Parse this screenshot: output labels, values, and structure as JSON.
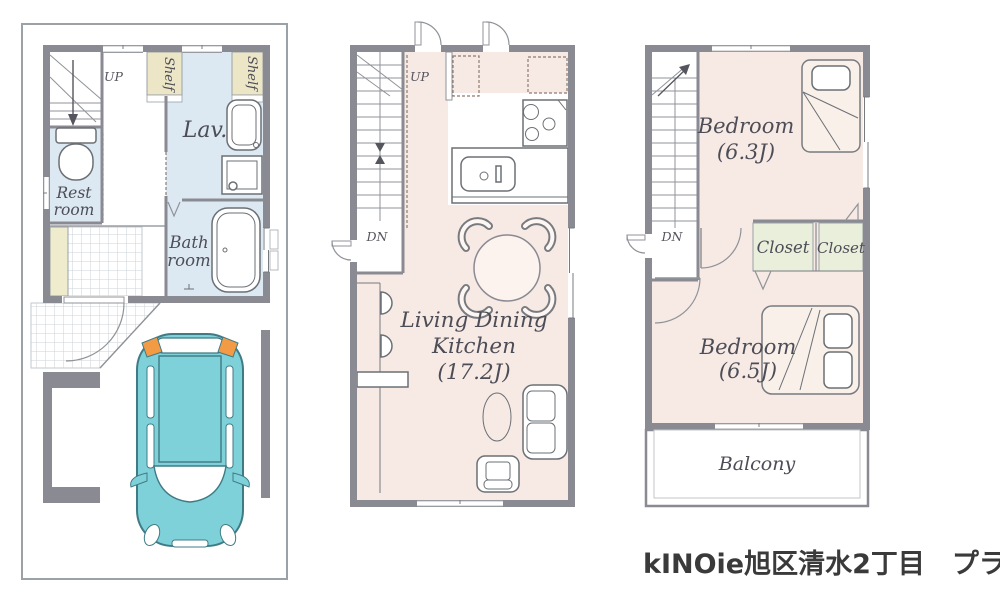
{
  "title": {
    "text": "kINOie旭区清水2丁目　プラン"
  },
  "floor1": {
    "up": "UP",
    "shelf_a": "Shelf",
    "shelf_b": "Shelf",
    "lavatory": "Lav.",
    "restroom_line1": "Rest",
    "restroom_line2": "room",
    "bathroom_line1": "Bath",
    "bathroom_line2": "room"
  },
  "floor2": {
    "up": "UP",
    "dn": "DN",
    "ldk_line1": "Living Dining",
    "ldk_line2": "Kitchen",
    "ldk_size": "(17.2J)"
  },
  "floor3": {
    "dn": "DN",
    "bedroom1_name": "Bedroom",
    "bedroom1_size": "(6.3J)",
    "closet_a": "Closet",
    "closet_b": "Closet",
    "bedroom2_name": "Bedroom",
    "bedroom2_size": "(6.5J)",
    "balcony": "Balcony"
  },
  "colors": {
    "wall": "#8a8a92",
    "water_room_blue": "#dde9f2",
    "floor_pink": "#f7eae4",
    "shelf_beige": "#ece6c7",
    "closet_green": "#e9efda",
    "tile_line": "#ccd3d8",
    "car_teal": "#7fd1d9",
    "car_outline": "#3f7b85",
    "car_light_orange": "#f29a44",
    "label_text": "#4d4d57",
    "title_text": "#3a3a3a"
  }
}
